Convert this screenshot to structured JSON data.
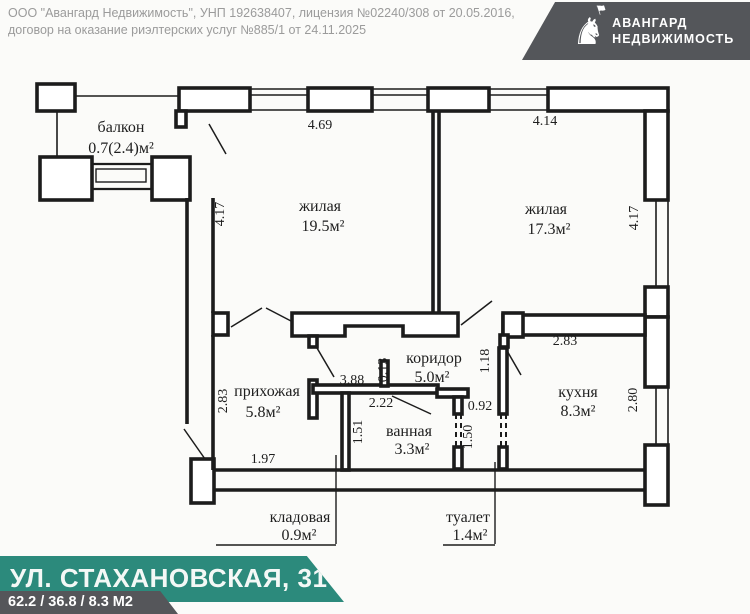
{
  "document": {
    "disclaimer": {
      "line1": "ООО \"Авангард Недвижимость\", УНП 192638407, лицензия №02240/308 от 20.05.2016,",
      "line2": "договор на оказание риэлтерских услуг №885/1 от 24.11.2025"
    },
    "logo": {
      "glyph": "♞",
      "flag_glyph": "⚑",
      "brand_line1": "АВАНГАРД",
      "brand_line2": "НЕДВИЖИМОСТЬ",
      "background": "#54565a"
    },
    "footer": {
      "address": "УЛ. СТАХАНОВСКАЯ, 31",
      "areas_summary": "62.2 / 36.8 / 8.3 М2",
      "banner_color": "#2c8a7c",
      "strip_color": "#55565a"
    }
  },
  "floor_plan": {
    "rooms": {
      "balcony": {
        "name": "балкон",
        "area": "0.7(2.4)м²"
      },
      "living1": {
        "name": "жилая",
        "area": "19.5м²"
      },
      "living2": {
        "name": "жилая",
        "area": "17.3м²"
      },
      "hallway": {
        "name": "прихожая",
        "area": "5.8м²"
      },
      "corridor": {
        "name": "коридор",
        "area": "5.0м²"
      },
      "bathroom": {
        "name": "ванная",
        "area": "3.3м²"
      },
      "kitchen": {
        "name": "кухня",
        "area": "8.3м²"
      },
      "storage": {
        "name": "кладовая",
        "area": "0.9м²"
      },
      "toilet": {
        "name": "туалет",
        "area": "1.4м²"
      }
    },
    "dimensions": {
      "living1_width": "4.69",
      "living1_depth": "4.17",
      "living2_width": "4.14",
      "living2_depth": "4.17",
      "hallway_depth": "2.83",
      "hallway_width": "1.97",
      "corridor_width": "3.88",
      "corridor_step": "0.13",
      "bathroom_width": "2.22",
      "bathroom_depth": "1.51",
      "toilet_offset": "1.18",
      "toilet_width": "0.92",
      "toilet_depth": "1.50",
      "kitchen_width": "2.83",
      "kitchen_depth": "2.80"
    }
  }
}
